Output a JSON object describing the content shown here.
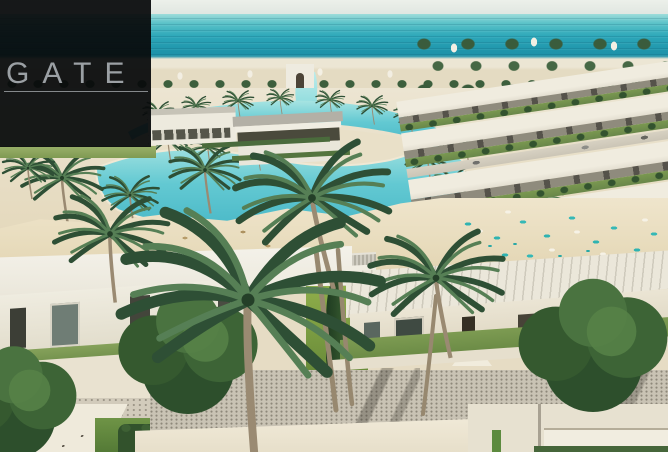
{
  "logo": {
    "text": "GATE"
  },
  "scene": {
    "type": "aerial-architectural-render",
    "description": "Aerial render of a coastal resort: pale sky over a turquoise sea, a swimmable lagoon and winding canal lined with sandy beaches, rows of white flat-roofed villas with lawns, beach parasols and loungers, and large palm trees over foreground villas, gravel driveways and gardens.",
    "elements": [
      "sky",
      "sea",
      "distant-shoreline",
      "lagoon",
      "canal",
      "arch-gate-building",
      "peninsula-pavilions",
      "right-villa-rows",
      "beach",
      "beach-umbrellas",
      "beach-loungers",
      "palm-trees",
      "round-trees",
      "foreground-villas",
      "windows",
      "lawns",
      "cypress-hedge",
      "gravel-driveway",
      "stone-patio",
      "bottom-roofs"
    ]
  },
  "palette": {
    "sky": "#e3e8e3",
    "sea_light": "#9edcda",
    "sea_deep": "#1b87a0",
    "lagoon": "#5ec9d4",
    "lagoon_shallow": "#a7e4e2",
    "sand": "#e8dcbd",
    "villa_white": "#efece0",
    "roof_grey": "#b2afa3",
    "palm_green_dark": "#2e4f35",
    "palm_green_light": "#567f55",
    "grass": "#7d9b52",
    "umbrella_teal": "#2fb3b1",
    "umbrella_straw": "#b79c6a",
    "logo_bg": "#0a0c0d",
    "logo_text": "#9ba0a4"
  }
}
